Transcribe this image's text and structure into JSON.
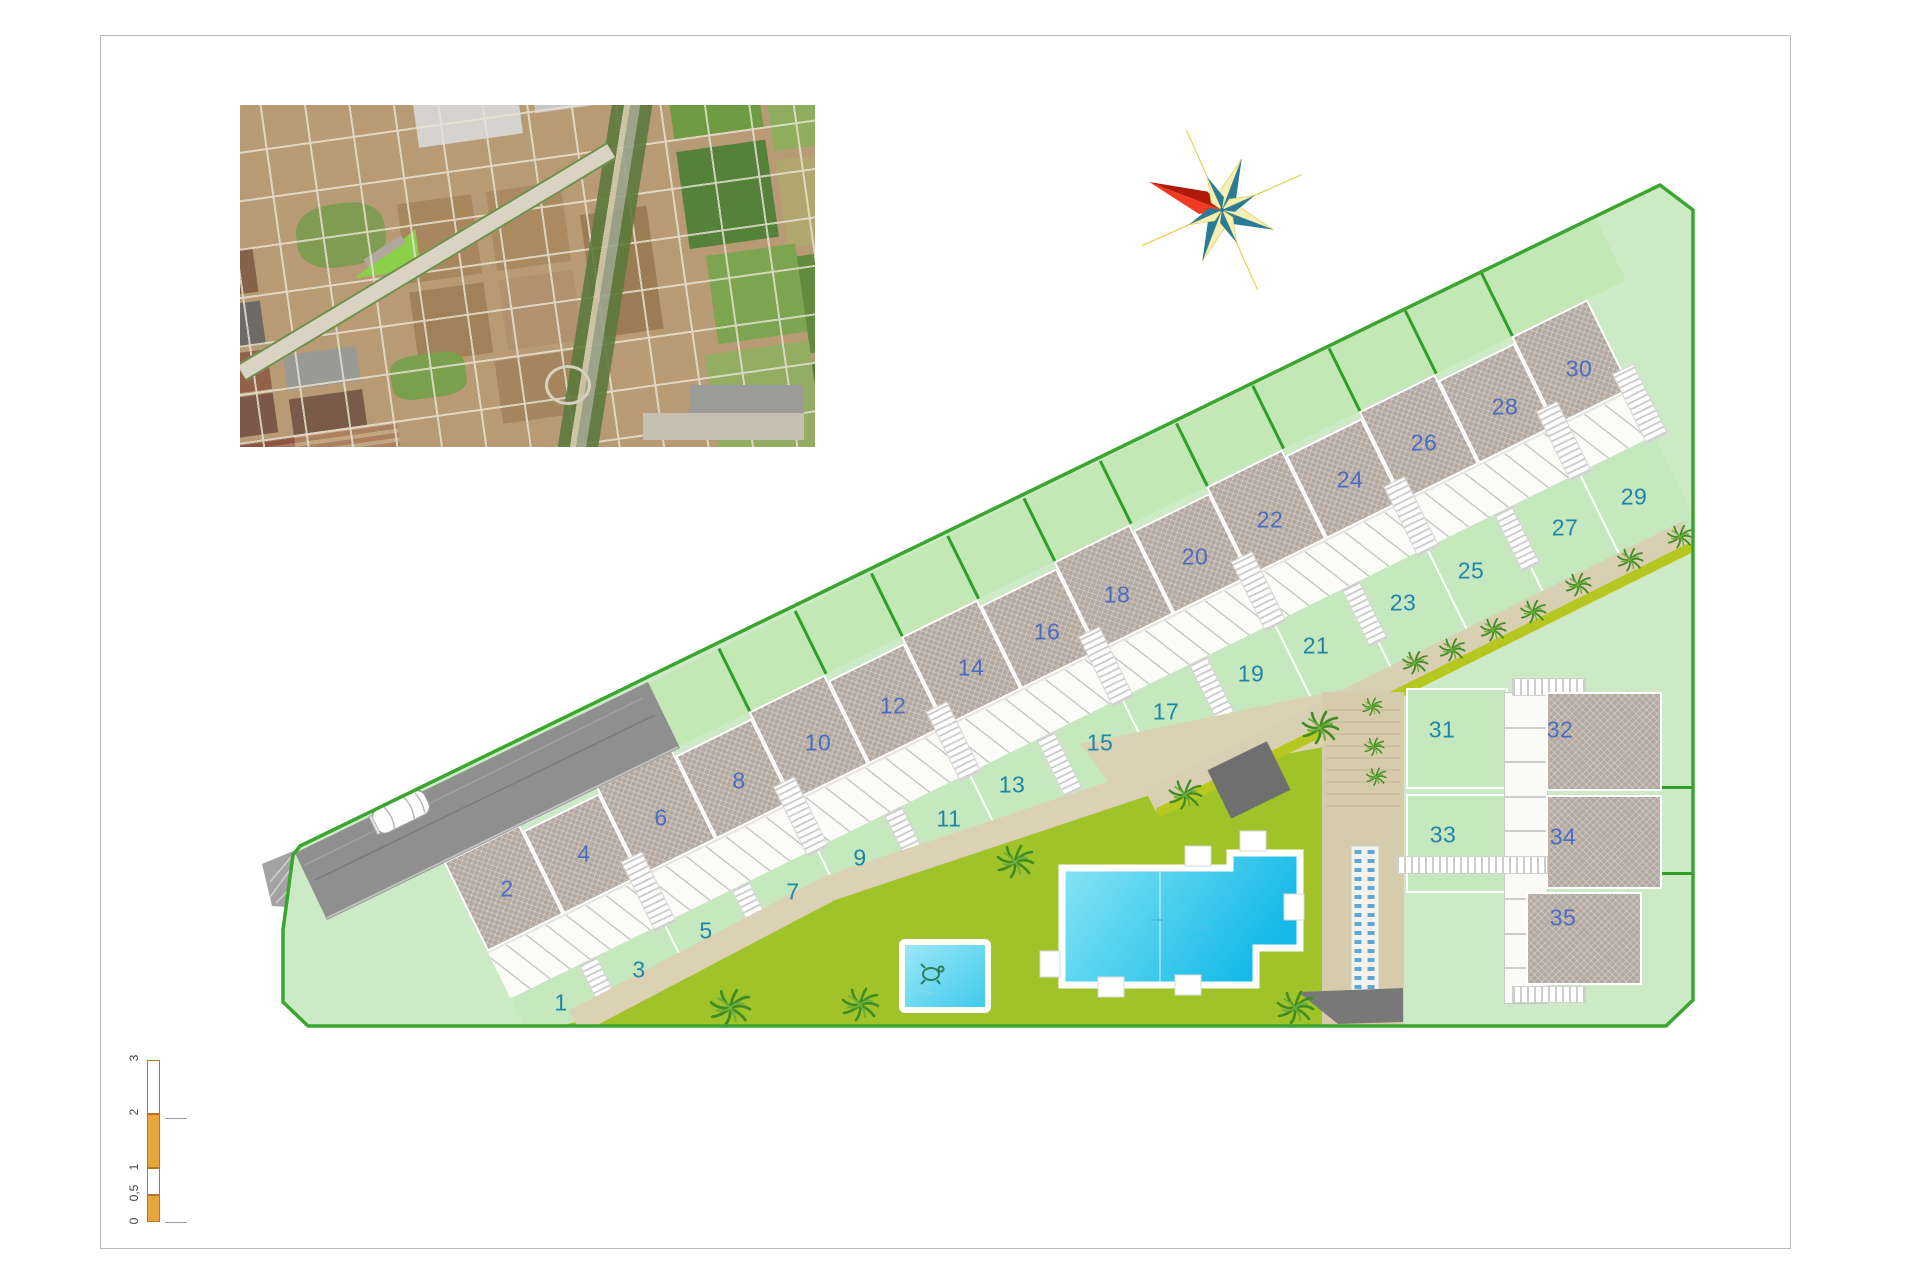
{
  "plan": {
    "plots": [
      {
        "n": "1",
        "x": 561,
        "y": 1003,
        "kind": "garden"
      },
      {
        "n": "2",
        "x": 507,
        "y": 889,
        "kind": "roof"
      },
      {
        "n": "3",
        "x": 639,
        "y": 970,
        "kind": "garden"
      },
      {
        "n": "4",
        "x": 584,
        "y": 854,
        "kind": "roof"
      },
      {
        "n": "5",
        "x": 706,
        "y": 931,
        "kind": "garden"
      },
      {
        "n": "6",
        "x": 661,
        "y": 818,
        "kind": "roof"
      },
      {
        "n": "7",
        "x": 793,
        "y": 892,
        "kind": "garden"
      },
      {
        "n": "8",
        "x": 739,
        "y": 781,
        "kind": "roof"
      },
      {
        "n": "9",
        "x": 860,
        "y": 858,
        "kind": "garden"
      },
      {
        "n": "10",
        "x": 818,
        "y": 743,
        "kind": "roof"
      },
      {
        "n": "11",
        "x": 949,
        "y": 819,
        "kind": "garden"
      },
      {
        "n": "12",
        "x": 893,
        "y": 706,
        "kind": "roof"
      },
      {
        "n": "13",
        "x": 1012,
        "y": 785,
        "kind": "garden"
      },
      {
        "n": "14",
        "x": 971,
        "y": 668,
        "kind": "roof"
      },
      {
        "n": "15",
        "x": 1100,
        "y": 743,
        "kind": "garden"
      },
      {
        "n": "16",
        "x": 1047,
        "y": 632,
        "kind": "roof"
      },
      {
        "n": "17",
        "x": 1166,
        "y": 712,
        "kind": "garden"
      },
      {
        "n": "18",
        "x": 1117,
        "y": 595,
        "kind": "roof"
      },
      {
        "n": "19",
        "x": 1251,
        "y": 674,
        "kind": "garden"
      },
      {
        "n": "20",
        "x": 1195,
        "y": 557,
        "kind": "roof"
      },
      {
        "n": "21",
        "x": 1316,
        "y": 646,
        "kind": "garden"
      },
      {
        "n": "22",
        "x": 1270,
        "y": 520,
        "kind": "roof"
      },
      {
        "n": "23",
        "x": 1403,
        "y": 603,
        "kind": "garden"
      },
      {
        "n": "24",
        "x": 1350,
        "y": 480,
        "kind": "roof"
      },
      {
        "n": "25",
        "x": 1471,
        "y": 571,
        "kind": "garden"
      },
      {
        "n": "26",
        "x": 1424,
        "y": 443,
        "kind": "roof"
      },
      {
        "n": "27",
        "x": 1565,
        "y": 528,
        "kind": "garden"
      },
      {
        "n": "28",
        "x": 1505,
        "y": 407,
        "kind": "roof"
      },
      {
        "n": "29",
        "x": 1634,
        "y": 497,
        "kind": "garden"
      },
      {
        "n": "30",
        "x": 1579,
        "y": 369,
        "kind": "roof"
      },
      {
        "n": "31",
        "x": 1442,
        "y": 730,
        "kind": "garden"
      },
      {
        "n": "32",
        "x": 1560,
        "y": 730,
        "kind": "roof"
      },
      {
        "n": "33",
        "x": 1443,
        "y": 835,
        "kind": "garden"
      },
      {
        "n": "34",
        "x": 1563,
        "y": 837,
        "kind": "roof"
      },
      {
        "n": "35",
        "x": 1563,
        "y": 918,
        "kind": "roof"
      }
    ],
    "row": {
      "unit_count": 15
    },
    "block_b": {
      "parking_bays": 8
    },
    "palms": [
      [
        730,
        1008,
        1.1
      ],
      [
        860,
        1005,
        1.0
      ],
      [
        1015,
        862,
        1.0
      ],
      [
        1185,
        795,
        0.9
      ],
      [
        1295,
        1008,
        1.0
      ],
      [
        1320,
        728,
        1.0
      ],
      [
        1372,
        707,
        0.55
      ],
      [
        1374,
        747,
        0.55
      ],
      [
        1376,
        777,
        0.55
      ],
      [
        1415,
        663,
        0.7
      ],
      [
        1452,
        650,
        0.7
      ],
      [
        1493,
        630,
        0.7
      ],
      [
        1533,
        612,
        0.7
      ],
      [
        1578,
        585,
        0.7
      ],
      [
        1630,
        560,
        0.7
      ],
      [
        1680,
        537,
        0.7
      ]
    ],
    "colors": {
      "site_green": "#cdeac6",
      "lawn_green": "#a1c32a",
      "boundary_green": "#3aa52f",
      "divider_green": "#2f9e2b",
      "roof_gray": "#b3a9a0",
      "path_tan": "#dbd1b5",
      "hedge_olive": "#b7c71f",
      "pool_cyan": "#17b8e6",
      "label_blue": "#4a6cc3",
      "label_teal": "#1f86a9",
      "compass_red": "#ef3b24",
      "compass_teal": "#2a7b96",
      "scale_orange": "#e9a43c"
    }
  },
  "scale_bar": {
    "labels": [
      {
        "t": "3",
        "y": 1059
      },
      {
        "t": "2",
        "y": 1113
      },
      {
        "t": "1",
        "y": 1168
      },
      {
        "t": "0,5",
        "y": 1194
      },
      {
        "t": "0",
        "y": 1222
      }
    ]
  }
}
